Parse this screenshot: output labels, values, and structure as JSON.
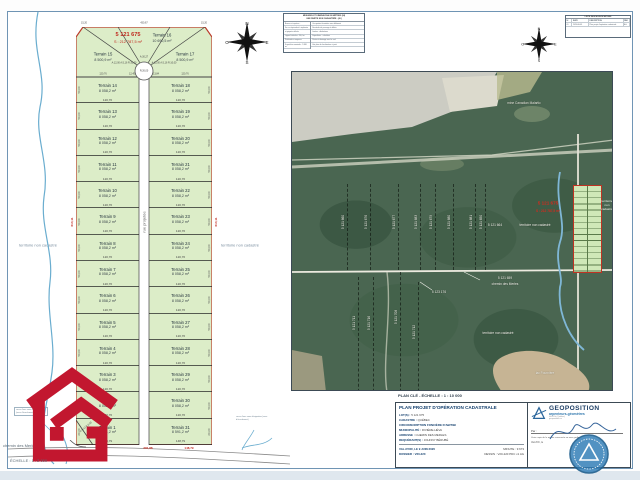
{
  "sheet": {
    "scale_label": "ÉCHELLE : 1 : 2 000",
    "road_label": "chemin des Merles",
    "territory_left": "territoire non cadastré",
    "territory_right": "territoire non cadastré",
    "note_left": "cours d'eau sans désignation (sens d'écoulement vers le sud)",
    "note_right": "cours d'eau sans désignation (sens d'écoulement)"
  },
  "plat": {
    "lot_number": "5 121 675",
    "lot_area": "S : 212 787,5 m²",
    "street": "rue projetée",
    "dim_top_left": "15,20",
    "dim_top_center": "430,67",
    "dim_top_right": "15,20",
    "dim_left": "610,11",
    "dim_right": "610,11",
    "dim_bottom_1": "281,88",
    "dim_bottom_2": "148,79",
    "corner_arc": "A:9,42  R:6,00",
    "fan": {
      "left_name": "Terrain 15",
      "left_area": "8 500,9 m²",
      "center_name": "Terrain 16",
      "center_area": "10 690,5 m²",
      "right_name": "Terrain 17",
      "right_area": "8 500,9 m²",
      "arc_label": "A:30,27",
      "radius_label": "R:26,00",
      "left_dims": "A:12,00 A:5,16 R:10,00",
      "right_dims": "A:12,00 A:5,16 R:10,00",
      "width_left": "120,76",
      "width_inner_left": "12,45",
      "width_inner_right": "13,84",
      "width_right": "120,76"
    },
    "rows": [
      {
        "l": "Terrain 14",
        "la": "8 058,2 m²",
        "r": "Terrain 18",
        "ra": "8 058,2 m²",
        "w": "120,76",
        "d": "50,00"
      },
      {
        "l": "Terrain 13",
        "la": "8 058,2 m²",
        "r": "Terrain 19",
        "ra": "8 058,2 m²",
        "w": "120,76",
        "d": "50,00"
      },
      {
        "l": "Terrain 12",
        "la": "8 058,2 m²",
        "r": "Terrain 20",
        "ra": "8 058,2 m²",
        "w": "120,76",
        "d": "50,00"
      },
      {
        "l": "Terrain 11",
        "la": "8 058,2 m²",
        "r": "Terrain 21",
        "ra": "8 058,2 m²",
        "w": "120,76",
        "d": "50,00"
      },
      {
        "l": "Terrain 10",
        "la": "8 058,2 m²",
        "r": "Terrain 22",
        "ra": "8 058,2 m²",
        "w": "120,76",
        "d": "50,00"
      },
      {
        "l": "Terrain 9",
        "la": "8 058,2 m²",
        "r": "Terrain 23",
        "ra": "8 058,2 m²",
        "w": "120,76",
        "d": "50,00"
      },
      {
        "l": "Terrain 8",
        "la": "8 058,2 m²",
        "r": "Terrain 24",
        "ra": "8 058,2 m²",
        "w": "120,76",
        "d": "50,00"
      },
      {
        "l": "Terrain 7",
        "la": "8 058,2 m²",
        "r": "Terrain 25",
        "ra": "8 058,2 m²",
        "w": "120,76",
        "d": "50,00"
      },
      {
        "l": "Terrain 6",
        "la": "8 058,2 m²",
        "r": "Terrain 26",
        "ra": "8 058,2 m²",
        "w": "120,76",
        "d": "50,00"
      },
      {
        "l": "Terrain 5",
        "la": "8 058,2 m²",
        "r": "Terrain 27",
        "ra": "8 058,2 m²",
        "w": "120,76",
        "d": "50,00"
      },
      {
        "l": "Terrain 4",
        "la": "8 058,2 m²",
        "r": "Terrain 28",
        "ra": "8 058,2 m²",
        "w": "120,76",
        "d": "50,00"
      },
      {
        "l": "Terrain 3",
        "la": "8 058,2 m²",
        "r": "Terrain 29",
        "ra": "8 058,2 m²",
        "w": "120,76",
        "d": "50,00"
      },
      {
        "l": "Terrain 2",
        "la": "8 058,2 m²",
        "r": "Terrain 30",
        "ra": "8 058,2 m²",
        "w": "120,76",
        "d": "50,00"
      },
      {
        "l": "Terrain 1",
        "la": "8 591,2 m²",
        "r": "Terrain 31",
        "ra": "8 591,2 m²",
        "w": "148,79",
        "d": "60,60"
      }
    ]
  },
  "legend": {
    "title1": "MESURES ET DIMENSIONS EN MÈTRES (SI)",
    "title2": "UNE PARTIE NON CADASTRÉE - (M.)",
    "left_rows": [
      "Bornes et repères :",
      "Fer ou équivalent à implanter",
      "et piquets utilisés",
      "Lignes latérales : 90,0 m",
      "Profondeur moyenne",
      "Superficie nominale : 5 860 m²"
    ],
    "right_rows": [
      "Occupation forestière sans bâtiment",
      "Servitude de passage à définir",
      "Limites : déductions",
      "Superficies : calculées",
      "Pente et drainage vers le sud",
      "Voir plan de localisation ci-joint"
    ]
  },
  "revisions": {
    "title": "LISTE DES MODIFICATIONS",
    "cols": [
      "N°",
      "DATE",
      "DESCRIPTION",
      "PAR"
    ],
    "rows": [
      [
        "01",
        "2020-06-09",
        "Plan projet d'opération cadastrale",
        "AG"
      ]
    ]
  },
  "map": {
    "caption": "PLAN CLÉ - ÉCHELLE : 1 : 10 000",
    "territory_edge": "territoire non cadastré",
    "lot_labels": [
      {
        "t": "5 121 660",
        "x": 51,
        "y": 150,
        "vert": true,
        "y1": 112,
        "y2": 198
      },
      {
        "t": "5 121 676",
        "x": 74,
        "y": 150,
        "vert": true,
        "y1": 112,
        "y2": 198
      },
      {
        "t": "5 121 677",
        "x": 102,
        "y": 150,
        "vert": true,
        "y1": 112,
        "y2": 198
      },
      {
        "t": "5 121 683",
        "x": 124,
        "y": 150,
        "vert": true,
        "y1": 112,
        "y2": 198
      },
      {
        "t": "5 121 679",
        "x": 139,
        "y": 150,
        "vert": true,
        "y1": 112,
        "y2": 198
      },
      {
        "t": "5 121 680",
        "x": 157,
        "y": 150,
        "vert": true,
        "y1": 112,
        "y2": 198
      },
      {
        "t": "5 121 681",
        "x": 179,
        "y": 150,
        "vert": true,
        "y1": 112,
        "y2": 198
      },
      {
        "t": "5 121 650",
        "x": 189,
        "y": 150,
        "vert": true,
        "y1": 112,
        "y2": 198
      },
      {
        "t": "5 121 711",
        "x": 62,
        "y": 251,
        "vert": true,
        "y1": 205,
        "y2": 330
      },
      {
        "t": "5 121 716",
        "x": 77,
        "y": 251,
        "vert": true,
        "y1": 205,
        "y2": 340
      },
      {
        "t": "5 121 708",
        "x": 104,
        "y": 245,
        "vert": true,
        "y1": 200,
        "y2": 335
      },
      {
        "t": "5 121 712",
        "x": 122,
        "y": 260,
        "vert": true,
        "y1": 210,
        "y2": 345
      },
      {
        "t": "5 121 664",
        "x": 203,
        "y": 153
      },
      {
        "t": "territoire non cadastré",
        "x": 243,
        "y": 153
      },
      {
        "t": "5 121 659",
        "x": 213,
        "y": 206
      },
      {
        "t": "chemin des Merles",
        "x": 213,
        "y": 212
      },
      {
        "t": "5 123 176",
        "x": 147,
        "y": 220
      },
      {
        "t": "territoire non cadastré",
        "x": 206,
        "y": 261
      },
      {
        "t": "lac Fournière",
        "x": 253,
        "y": 301
      },
      {
        "t": "mine Canadian Malartic",
        "x": 232,
        "y": 31,
        "dark": true
      },
      {
        "t": "5 121 675",
        "x": 256,
        "y": 131,
        "red": true,
        "big": true
      },
      {
        "t": "S : 212 787,5 m²",
        "x": 256,
        "y": 139,
        "red": true
      }
    ]
  },
  "title_block": {
    "title": "PLAN PROJET D'OPÉRATION CADASTRALE",
    "fields": [
      {
        "label": "LOT(S)",
        "value": "5 121 675"
      },
      {
        "label": "CADASTRE",
        "value": "QUÉBEC"
      },
      {
        "label": "CIRCONSCRIPTION FONCIÈRE D'ABITIBI",
        "value": ""
      },
      {
        "label": "MUNICIPALITÉ",
        "value": "RIVIÈRE-HÉVA"
      },
      {
        "label": "ADRESSE",
        "value": "CHEMIN DES MERLES"
      },
      {
        "label": "REQUÉRANT(S)",
        "value": "JOHNNY BÉRUBÉ"
      }
    ],
    "footer_rows": [
      {
        "left": "VAL-D'OR, LE 9 JUIN 2020",
        "right": "MINUTE : 9 673"
      },
      {
        "left": "DOSSIER : V20-220",
        "right": "DESSIN : V20-220 PDC v1 AG"
      }
    ],
    "firm": {
      "name": "GEOPOSITION",
      "subtitle": "arpenteurs-géomètres",
      "addr1": "Val-d'Or (Québec)",
      "addr2": "geoposition.ca",
      "par_label": "Par :",
      "copy_note": "Vraie copie de la minute conservée en mon greffe.",
      "place_line": "Val-d'Or, le"
    }
  }
}
